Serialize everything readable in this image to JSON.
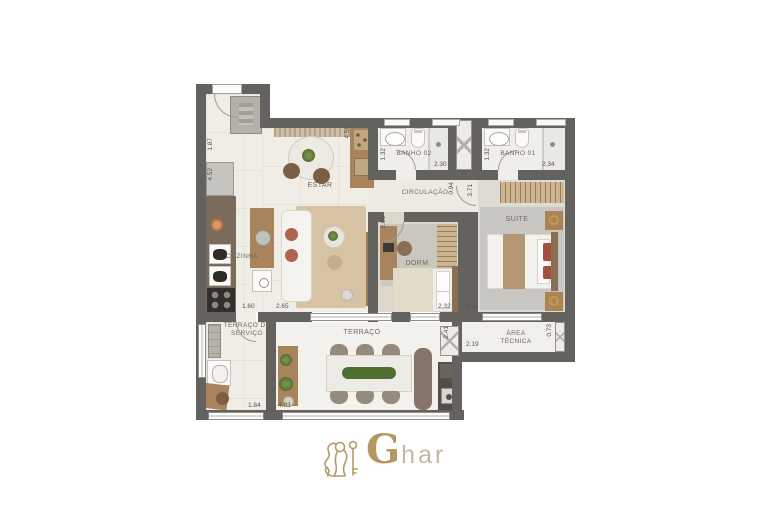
{
  "plan": {
    "rooms": {
      "estar": "ESTAR",
      "cozinha": "COZINHA",
      "banho02": "BANHO 02",
      "banho01": "BANHO 01",
      "circulacao": "CIRCULAÇÃO",
      "dorm": "DORM",
      "suite": "SUITE",
      "terraco_servico": "TERRAÇO DE SERVIÇO",
      "terraco": "TERRAÇO",
      "area_tecnica": "ÁREA TÉCNICA"
    },
    "dimensions": {
      "left_wall_upper": "1.87",
      "left_wall_lower": "4.52",
      "estar_depth": "4.58",
      "banho02_depth": "1.32",
      "banho02_width": "2.30",
      "banho01_depth": "1.32",
      "banho01_width": "2.34",
      "circulacao_depth": "0.94",
      "suite_depth": "3.71",
      "dorm_depth": "2.66",
      "cozinha_width": "1.60",
      "estar_width": "2.65",
      "dorm_width": "2.32",
      "suite_width": "2.51",
      "terraco_depth": "2.41",
      "area_tecnica_width": "2.19",
      "area_tecnica_depth": "0.73",
      "terraco_servico_width": "1.84",
      "terraco_width": "4.93"
    }
  },
  "logo": {
    "initial": "G",
    "rest": "har"
  },
  "colors": {
    "wall": "#64625e",
    "brand_gold": "#b5985f",
    "accent_terracotta": "#ad6350",
    "wood": "#a8835c"
  }
}
